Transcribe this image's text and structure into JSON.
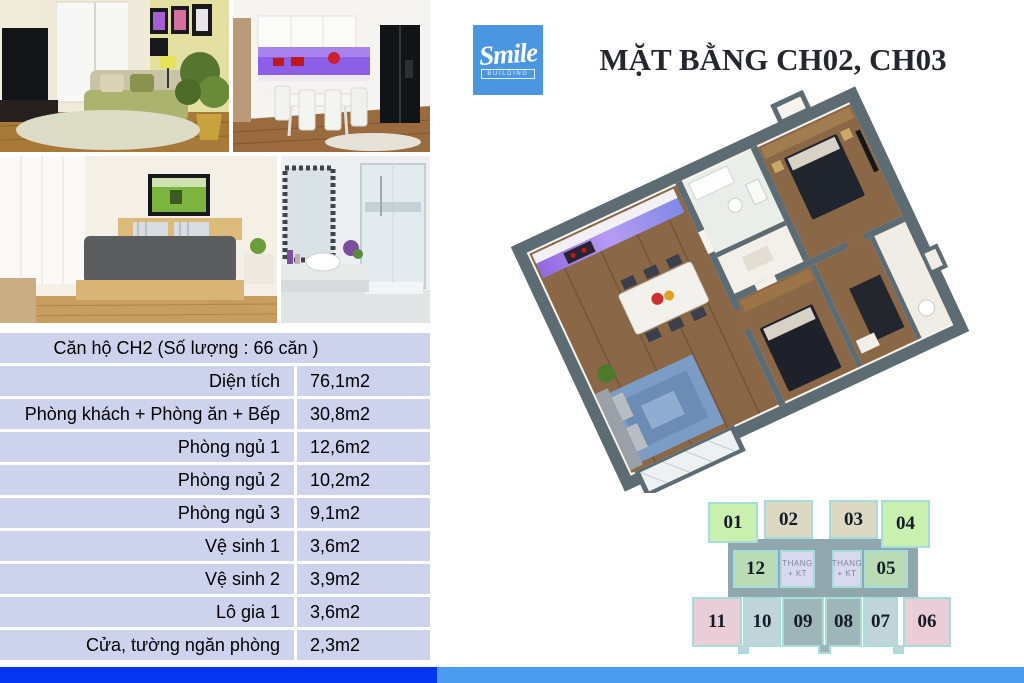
{
  "header": {
    "logo_text": "Smile",
    "logo_subtext": "BUILDING",
    "title": "MẶT BẰNG CH02, CH03"
  },
  "spec_table": {
    "header": "Căn hộ CH2 (Số lượng : 66 căn )",
    "rows": [
      {
        "label": "Diện tích",
        "value": "76,1m2"
      },
      {
        "label": "Phòng khách + Phòng ăn + Bếp",
        "value": "30,8m2"
      },
      {
        "label": "Phòng ngủ 1",
        "value": "12,6m2"
      },
      {
        "label": "Phòng ngủ 2",
        "value": "10,2m2"
      },
      {
        "label": "Phòng ngủ 3",
        "value": "9,1m2"
      },
      {
        "label": "Vệ sinh 1",
        "value": "3,6m2"
      },
      {
        "label": "Vệ sinh 2",
        "value": "3,9m2"
      },
      {
        "label": "Lô gia 1",
        "value": "3,6m2"
      },
      {
        "label": "Cửa,  tường ngăn phòng",
        "value": "2,3m2"
      }
    ]
  },
  "unit_map": {
    "thang": {
      "line1": "THANG",
      "line2": "+ KT"
    },
    "units": [
      {
        "id": "01",
        "color": "#c9f0ae"
      },
      {
        "id": "02",
        "color": "#ddd8c2"
      },
      {
        "id": "03",
        "color": "#ddd8c2"
      },
      {
        "id": "04",
        "color": "#c9f0ae"
      },
      {
        "id": "12",
        "color": "#b9dcb4"
      },
      {
        "id": "05",
        "color": "#b9dcb4"
      },
      {
        "id": "11",
        "color": "#e9ced8"
      },
      {
        "id": "10",
        "color": "#c0d4da"
      },
      {
        "id": "09",
        "color": "#9fb6b8"
      },
      {
        "id": "08",
        "color": "#9fb6b8"
      },
      {
        "id": "07",
        "color": "#c0d4da"
      },
      {
        "id": "06",
        "color": "#e9ced8"
      }
    ]
  },
  "photos": [
    {
      "name": "living-room"
    },
    {
      "name": "kitchen-dining"
    },
    {
      "name": "bedroom"
    },
    {
      "name": "bathroom"
    }
  ],
  "colors": {
    "logo_bg": "#4b96e0",
    "table_row_bg": "#cdd3ed",
    "footer_left": "#0535f0",
    "footer_right": "#4c9cf2",
    "plan_wall": "#5d6c72",
    "plan_wood": "#8a6747",
    "core_gray": "#91a7ae",
    "outline_teal": "#a5dcdc"
  }
}
